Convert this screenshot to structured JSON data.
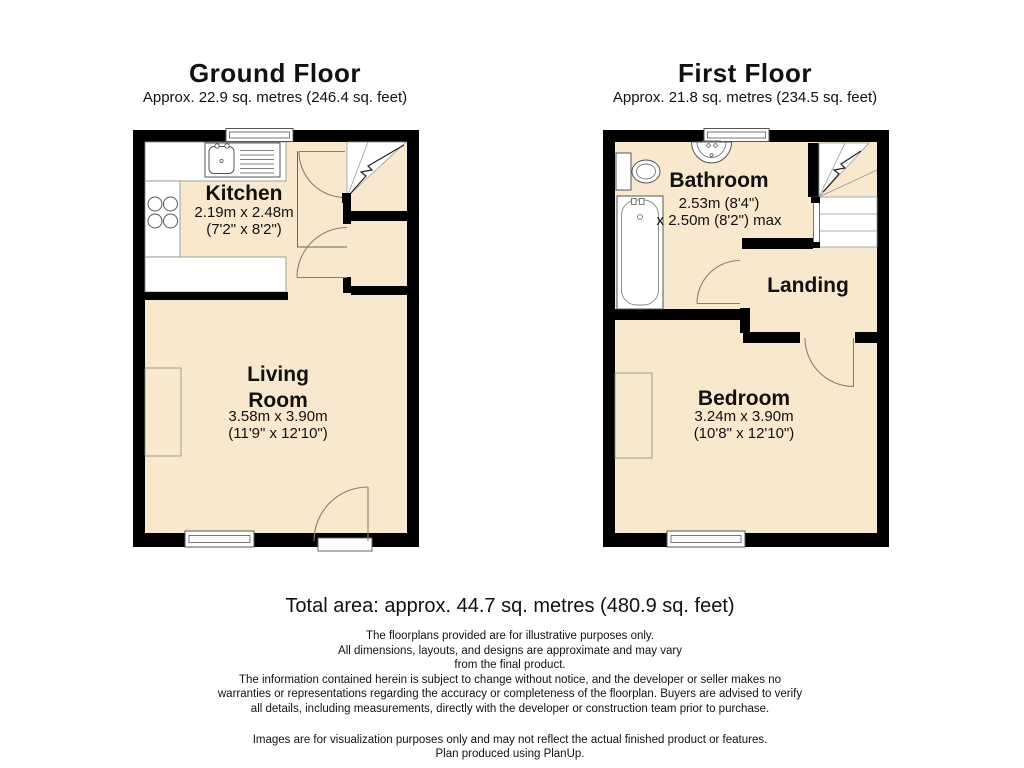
{
  "ground_floor": {
    "title": "Ground Floor",
    "area": "Approx. 22.9 sq. metres (246.4 sq. feet)",
    "rooms": {
      "kitchen": {
        "name": "Kitchen",
        "dims_metric": "2.19m x 2.48m",
        "dims_imperial": "(7'2\" x 8'2\")"
      },
      "living_room": {
        "name": "Living Room",
        "dims_metric": "3.58m x 3.90m",
        "dims_imperial": "(11'9\" x 12'10\")"
      }
    }
  },
  "first_floor": {
    "title": "First Floor",
    "area": "Approx. 21.8 sq. metres (234.5 sq. feet)",
    "rooms": {
      "bathroom": {
        "name": "Bathroom",
        "dims_line1": "2.53m (8'4\")",
        "dims_line2": "x 2.50m (8'2\") max"
      },
      "landing": {
        "name": "Landing"
      },
      "bedroom": {
        "name": "Bedroom",
        "dims_metric": "3.24m x 3.90m",
        "dims_imperial": "(10'8\" x 12'10\")"
      }
    }
  },
  "footer": {
    "total_area": "Total area: approx. 44.7 sq. metres (480.9 sq. feet)",
    "disclaimer_lines": [
      "The floorplans provided are for illustrative purposes only.",
      "All dimensions, layouts, and designs are approximate and may vary",
      "from the final product.",
      "The information contained herein is subject to change without notice, and the developer or seller makes no",
      "warranties or representations regarding the accuracy or completeness of the floorplan. Buyers are advised to verify",
      "all details, including measurements, directly with the developer or construction team prior to purchase.",
      "Images are for visualization purposes only and may not reflect the actual finished product or features.",
      "Plan produced using PlanUp."
    ]
  },
  "colors": {
    "floor_fill": "#F8E9CE",
    "wall": "#000000",
    "fixture_line": "#555555",
    "door_arc": "#8d7d68",
    "stair_line": "#999999"
  }
}
